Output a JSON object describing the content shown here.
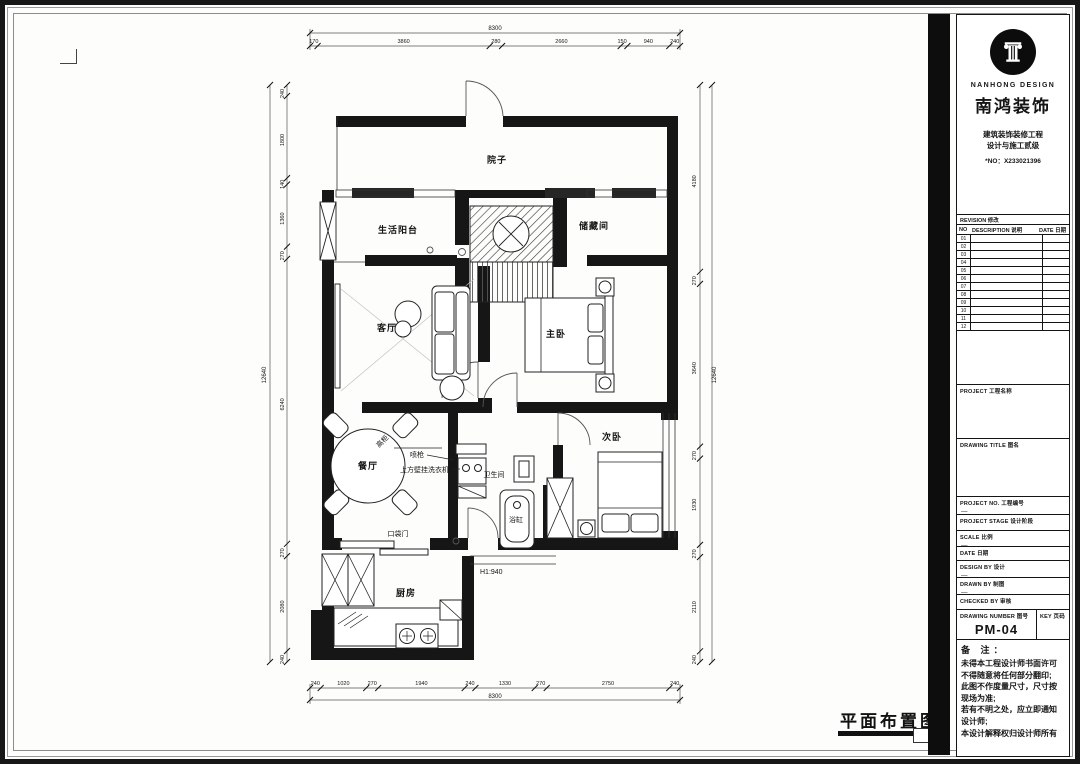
{
  "company": {
    "logo_en": "NANHONG DESIGN",
    "logo_cn": "南鸿装饰",
    "cert_line1": "建筑装饰装修工程",
    "cert_line2": "设计与施工贰级",
    "cert_no": "*NO：X233021396"
  },
  "revision_table": {
    "title": "REVISION  修改",
    "col_no": "NO",
    "col_desc": "DESCRIPTION  说明",
    "col_date": "DATE  日期",
    "rows": [
      "01",
      "02",
      "03",
      "04",
      "05",
      "06",
      "07",
      "08",
      "09",
      "10",
      "11",
      "12"
    ]
  },
  "title_block": {
    "project_label": "PROJECT    工程名称",
    "drawing_title_label": "DRAWING TITLE    图名",
    "project_no_label": "PROJECT NO.    工程编号",
    "project_no_value": "—",
    "project_stage_label": "PROJECT STAGE    设计阶段",
    "scale_label": "SCALE    比例",
    "scale_value": "—",
    "date_label": "DATE    日期",
    "design_by_label": "DESIGN BY    设计",
    "design_by_value": "—",
    "drawn_by_label": "DRAWN BY    制图",
    "drawn_by_value": "—",
    "checked_by_label": "CHECKED BY    审核",
    "drawing_number_label": "DRAWING NUMBER    图号",
    "key_label": "KEY  页码",
    "drawing_number": "PM-04"
  },
  "remarks": {
    "title": "备  注：",
    "lines": [
      "未得本工程设计师书面许可",
      "不得随意将任何部分翻印;",
      "此图不作度量尺寸，尺寸按",
      "现场为准;",
      "若有不明之处，应立即通知",
      "设计师;",
      "本设计解释权归设计师所有"
    ]
  },
  "floor_plan": {
    "title": "平面布置图",
    "rooms": {
      "courtyard": "院子",
      "living_balcony": "生活阳台",
      "storage": "储藏间",
      "living_room": "客厅",
      "master_bedroom": "主卧",
      "second_bedroom": "次卧",
      "dining_room": "餐厅",
      "bathroom": "卫生间",
      "kitchen": "厨房"
    },
    "annotations": {
      "bathtub": "浴缸",
      "tall_cabinet": "高柜",
      "spray_gun": "喷枪",
      "wall_washer": "上方壁挂洗衣机",
      "pocket_door": "口袋门",
      "wall_height": "H1:940"
    },
    "dimensions": {
      "top": {
        "total": "8300",
        "segments": [
          "170",
          "3860",
          "280",
          "2660",
          "150",
          "940",
          "240"
        ]
      },
      "bottom": {
        "total": "8300",
        "segments": [
          "240",
          "1020",
          "270",
          "1940",
          "240",
          "1330",
          "270",
          "2750",
          "240"
        ]
      },
      "left": {
        "total": "12640",
        "segments": [
          "240",
          "1800",
          "140",
          "1360",
          "270",
          "6240",
          "270",
          "2080",
          "240"
        ]
      },
      "right": {
        "total": "12640",
        "segments": [
          "4180",
          "270",
          "3640",
          "270",
          "1930",
          "270",
          "2110",
          "240"
        ]
      }
    }
  }
}
